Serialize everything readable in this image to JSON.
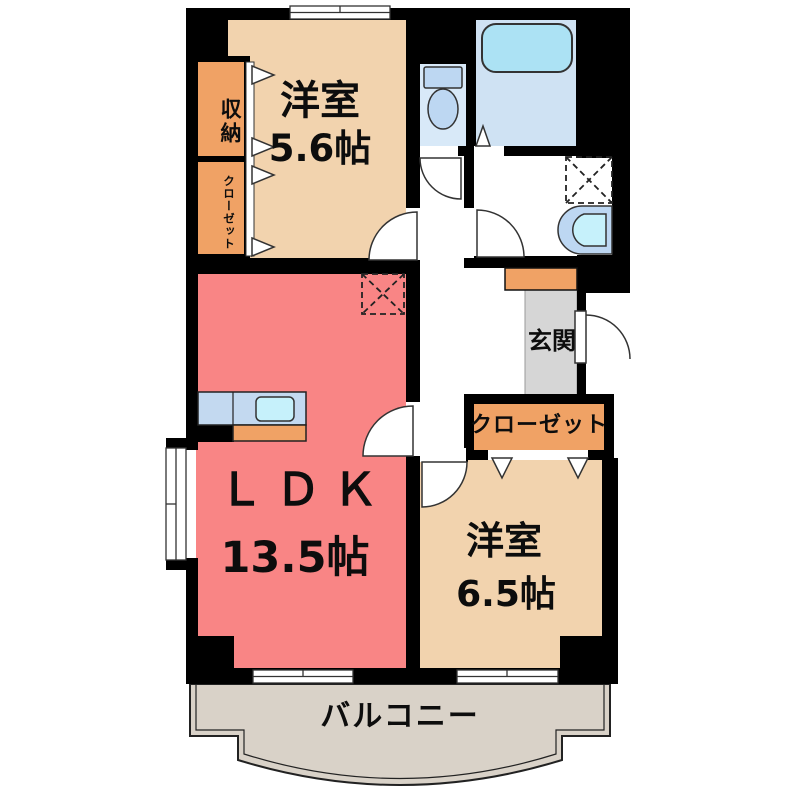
{
  "floorplan": {
    "type": "apartment-2LDK",
    "rooms": {
      "western1": {
        "label": "洋室",
        "size": "5.6帖"
      },
      "ldk": {
        "label": "ＬＤＫ",
        "size": "13.5帖"
      },
      "western2": {
        "label": "洋室",
        "size": "6.5帖"
      },
      "entrance": {
        "label": "玄関"
      },
      "balcony": {
        "label": "バルコニー"
      },
      "storage": {
        "label": "収納"
      },
      "closet_side": {
        "label": "クローゼット"
      },
      "closet_main": {
        "label": "クローゼット"
      }
    },
    "colors": {
      "wall": "#000000",
      "western_room": "#f2d3ae",
      "ldk": "#f98585",
      "storage_box": "#f0a265",
      "entrance_floor": "#d6d6d6",
      "balcony_floor": "#d9d2c8",
      "bath_floor": "#cfe2f3",
      "toilet_room": "#d8e9f8",
      "bathtub": "#ace2f4",
      "fixture": "#bdd7f2",
      "sink_bowl": "#c6f1fb",
      "kitchen_counter": "#c3d9f0"
    }
  }
}
